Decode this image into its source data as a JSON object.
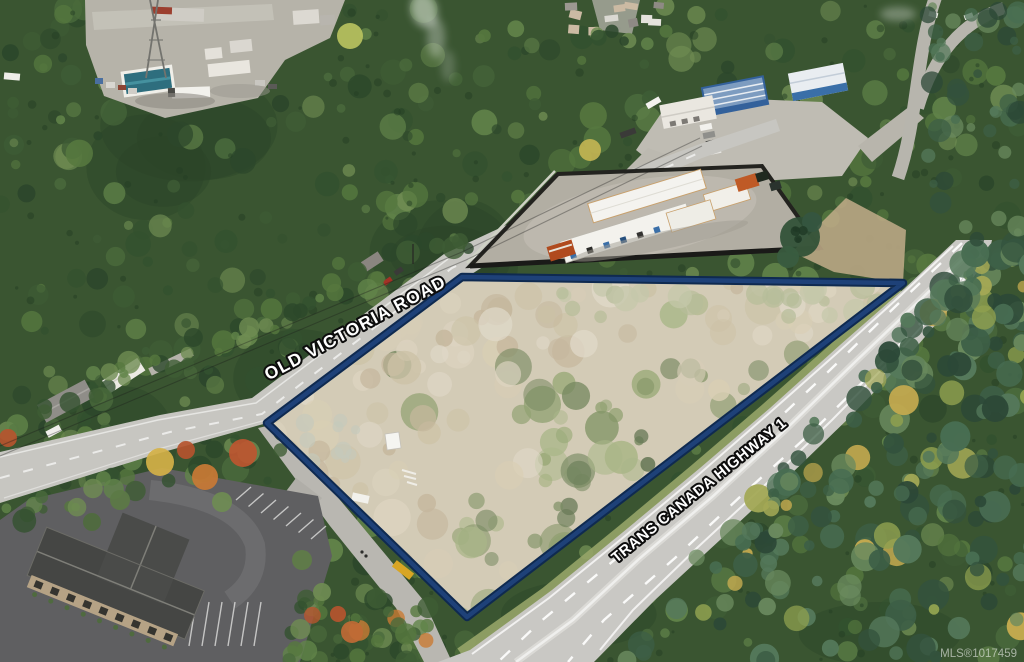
{
  "labels": {
    "old_victoria_road": "OLD VICTORIA ROAD",
    "trans_canada_highway": "TRANS CANADA HIGHWAY 1"
  },
  "watermark": {
    "text": "MLS®1017459"
  },
  "boundary": {
    "points_str": "267,423 462,277 903,283 467,617",
    "color_outer": "#0f2a50",
    "color_inner": "#1e4178",
    "lot_wash": "rgba(255,255,255,0.16)"
  },
  "label_style": {
    "fill": "#ffffff",
    "outline": "#0d0d0d"
  },
  "watermark_style": {
    "fill": "#ffffff"
  }
}
